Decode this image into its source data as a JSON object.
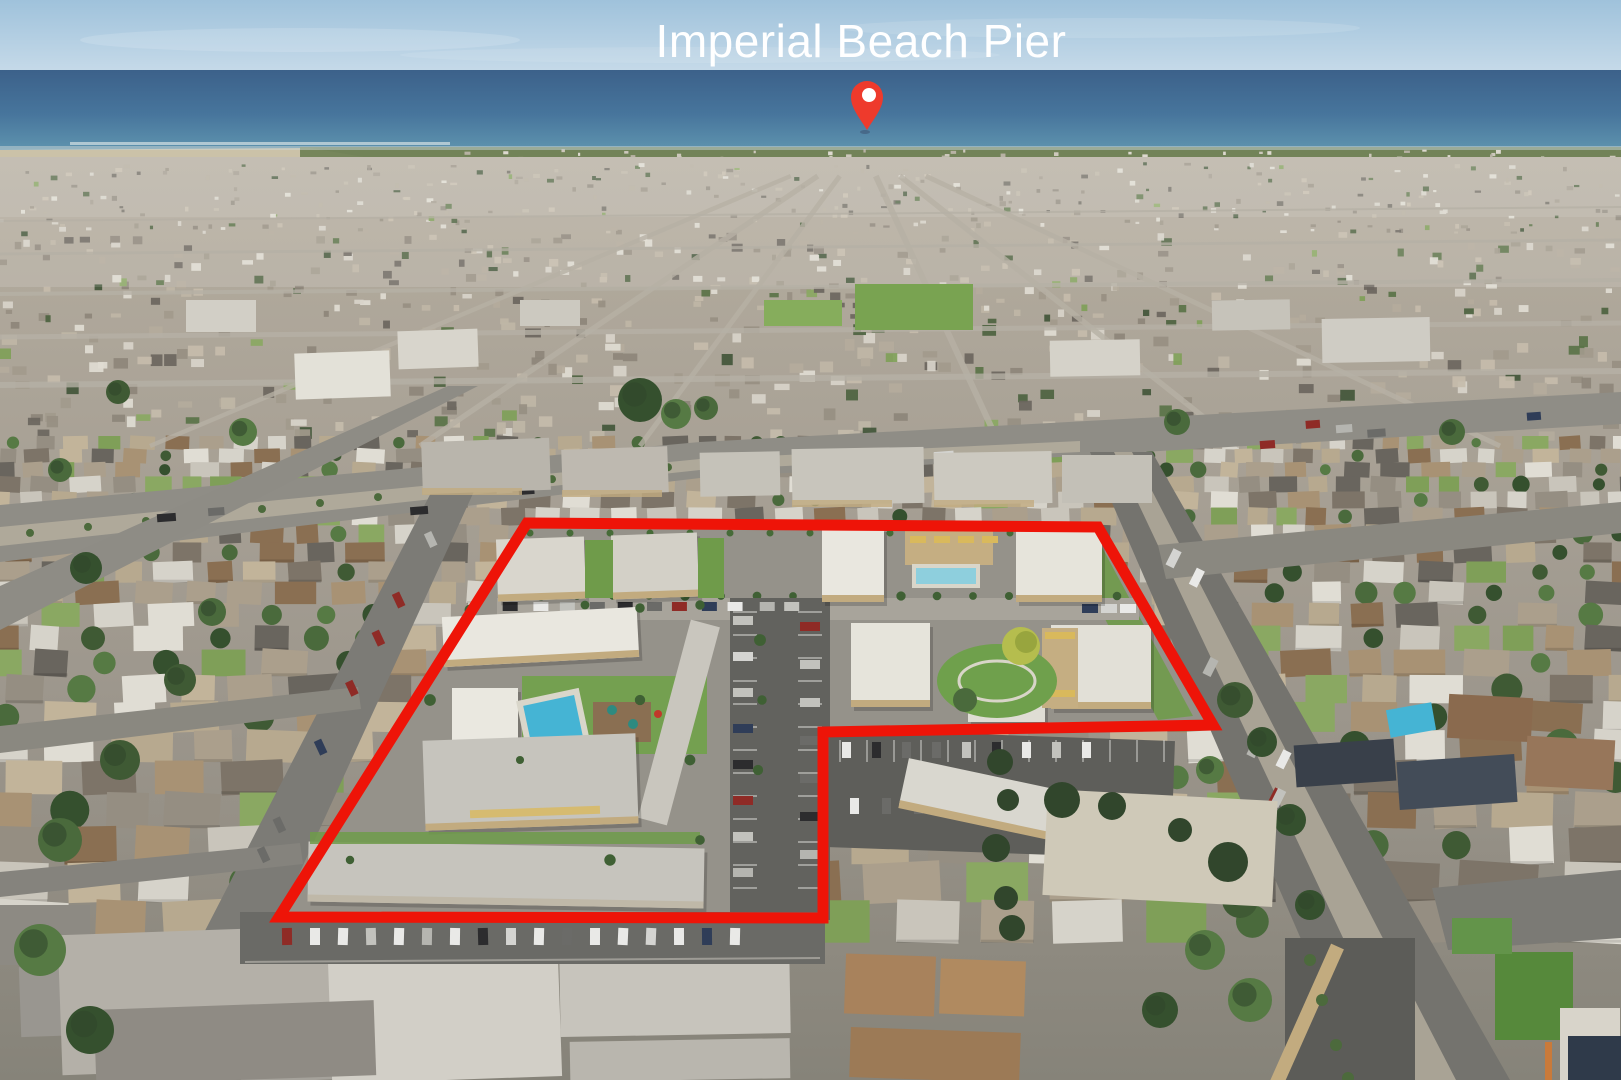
{
  "annotation": {
    "title": "Imperial Beach Pier",
    "title_color": "#ffffff",
    "pin": {
      "cx": 867,
      "tip_y": 130,
      "color": "#ee3a2c",
      "edge_color": "#c41e14",
      "hole_color": "#ffffff"
    },
    "property_outline": {
      "points_str": "527,523 1098,527 1213,725 823,732 823,918 279,917",
      "points": [
        [
          527,
          523
        ],
        [
          1098,
          527
        ],
        [
          1213,
          725
        ],
        [
          823,
          732
        ],
        [
          823,
          918
        ],
        [
          279,
          917
        ]
      ],
      "color": "#ee1408",
      "stroke_width": 11
    }
  },
  "scene": {
    "type": "aerial-drone-photograph",
    "regions": [
      "sky",
      "ocean",
      "shoreline-sand-flats",
      "marsh",
      "beachfront-town",
      "city-sprawl",
      "street-grid",
      "apartment-complex-property",
      "swimming-pools",
      "parking-lots"
    ],
    "palette": {
      "sky_top": "#9fc2db",
      "sky_bottom": "#c9dcea",
      "ocean_top": "#3c618a",
      "ocean_mid": "#47759c",
      "ocean_bottom": "#5e93ae",
      "surf": "#dfe8e8",
      "sand": "#cbc2a8",
      "marsh": "#6d7f52",
      "city_far": "#b5ad9f",
      "city_mid": "#9c968c",
      "city_near": "#868379",
      "road": "#8f8d86",
      "road_dark": "#74736e",
      "concrete": "#b3ac9c",
      "lawn": "#7f9f58",
      "lawn_bright": "#5f9340",
      "tree": "#42563a",
      "tree_dark": "#31462c",
      "pool": "#45b4d4",
      "pool_light": "#8ecfdd",
      "roof_white": "#e9e7df",
      "roof_gray": "#c6c4bd",
      "wall_tan": "#c2ab7f",
      "awning_yellow": "#d9b95c",
      "asphalt": "#62625e"
    }
  }
}
